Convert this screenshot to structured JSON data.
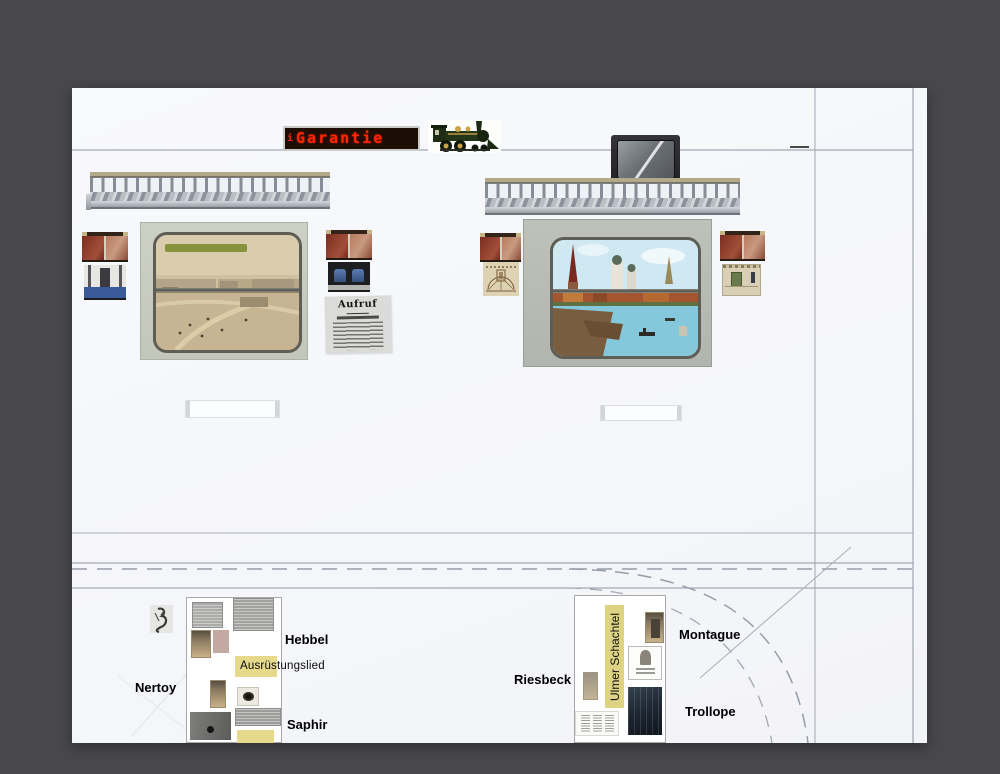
{
  "scene": {
    "type": "design-collage",
    "description": "Railway carriage interior elevation collage with plan drawing and annotations"
  },
  "led_sign": {
    "prefix": "i",
    "text": "Garantie",
    "text_color": "#ff2800",
    "panel_color": "#1d0e05"
  },
  "newspaper": {
    "headline": "Aufruf"
  },
  "labels": {
    "hebbel": "Hebbel",
    "ausruestungslied": "Ausrüstungslied",
    "nertoy": "Nertoy",
    "saphir": "Saphir",
    "riesbeck": "Riesbeck",
    "ulmer_schachtel": "Ulmer Schachtel",
    "montague": "Montague",
    "trollope": "Trollope"
  },
  "colors": {
    "background": "#48484b",
    "canvas": "#f7f8fb",
    "pencil_line": "#99a0ab",
    "highlight_yellow": "#e7d98c",
    "led_red": "#ff2800",
    "rack_metal": "#99a0a8",
    "window_frame_left": "#c8cbc0",
    "window_frame_right": "#b8bbb4"
  }
}
